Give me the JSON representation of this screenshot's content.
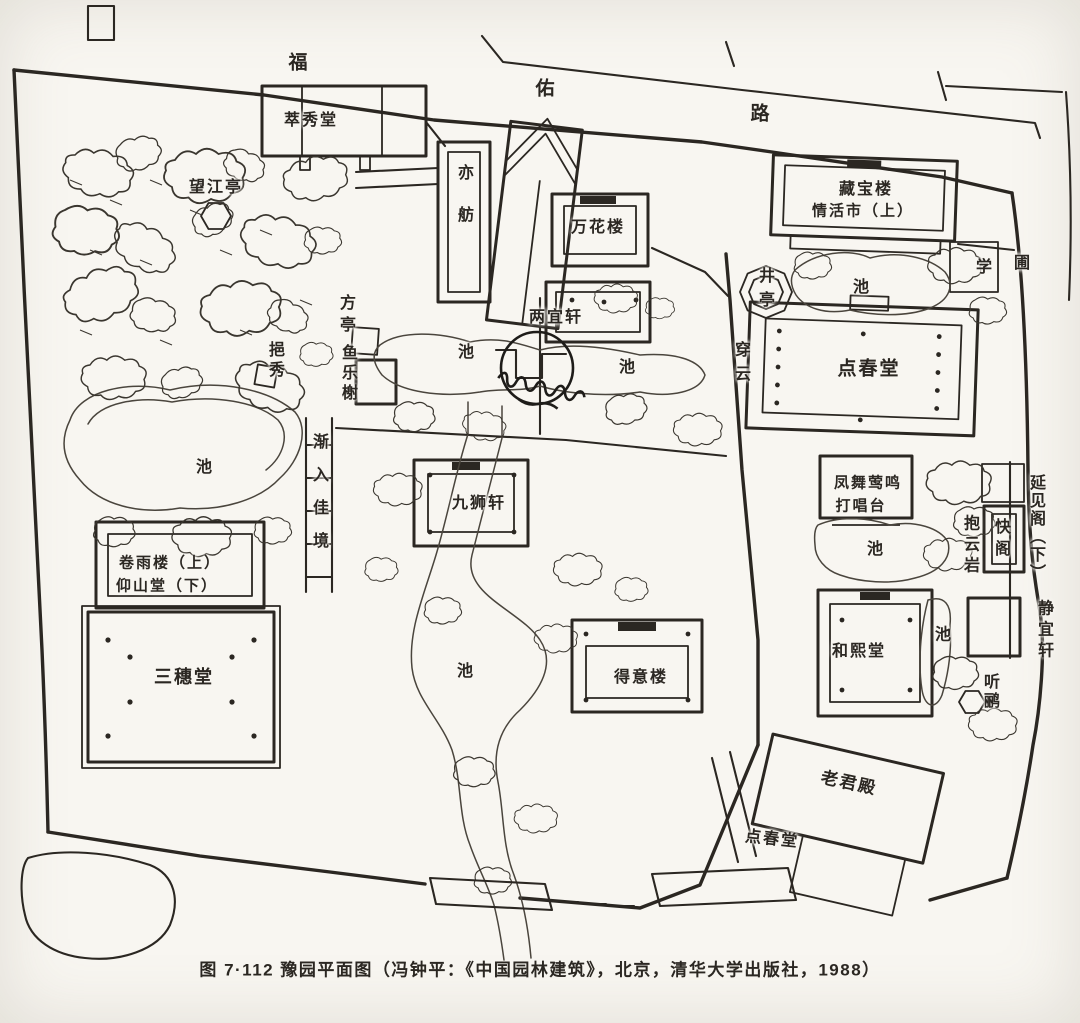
{
  "colors": {
    "paper": "#f8f6f1",
    "ink": "#2b2722",
    "water": "#4a453d"
  },
  "figure": {
    "caption": "图 7·112 豫园平面图（冯钟平：《中国园林建筑》，北京，清华大学出版社，1988）"
  },
  "road": {
    "name": "福佑路"
  },
  "labels": [
    {
      "name": "road-char",
      "text": "福",
      "x": 299,
      "y": 63,
      "dir": "h",
      "size": 19
    },
    {
      "name": "road-char",
      "text": "佑",
      "x": 546,
      "y": 89,
      "dir": "h",
      "size": 19
    },
    {
      "name": "road-char",
      "text": "路",
      "x": 761,
      "y": 114,
      "dir": "h",
      "size": 19
    },
    {
      "name": "label-cuixiutang",
      "text": "萃秀堂",
      "x": 311,
      "y": 121,
      "dir": "h"
    },
    {
      "name": "label-wangjiangting",
      "text": "望江亭",
      "x": 216,
      "y": 188,
      "dir": "h"
    },
    {
      "name": "label-yifang",
      "text": "亦舫",
      "x": 463,
      "y": 206,
      "dir": "v",
      "spacing": 26
    },
    {
      "name": "label-wanhualou",
      "text": "万花楼",
      "x": 598,
      "y": 228,
      "dir": "h"
    },
    {
      "name": "label-cangbaolou",
      "text": "藏宝楼",
      "x": 866,
      "y": 190,
      "dir": "h"
    },
    {
      "name": "label-cangbaolou-line2",
      "text": "情活市（上）",
      "x": 863,
      "y": 211,
      "dir": "h",
      "size": 15
    },
    {
      "name": "label-xue",
      "text": "学",
      "x": 985,
      "y": 268,
      "dir": "h"
    },
    {
      "name": "label-pu",
      "text": "圃",
      "x": 1023,
      "y": 264,
      "dir": "h"
    },
    {
      "name": "label-jingting",
      "text": "井亭",
      "x": 764,
      "y": 291,
      "dir": "v",
      "spacing": 8
    },
    {
      "name": "label-pond",
      "text": "池",
      "x": 862,
      "y": 288,
      "dir": "h"
    },
    {
      "name": "label-chuanyun",
      "text": "穿云",
      "x": 740,
      "y": 365,
      "dir": "v",
      "spacing": 8
    },
    {
      "name": "label-dianchuntang",
      "text": "点春堂",
      "x": 869,
      "y": 369,
      "dir": "h",
      "size": 19
    },
    {
      "name": "label-fangting",
      "text": "方亭",
      "x": 345,
      "y": 316,
      "dir": "v",
      "spacing": 6
    },
    {
      "name": "label-liangyixuan",
      "text": "两宜轩",
      "x": 556,
      "y": 318,
      "dir": "h"
    },
    {
      "name": "label-pond",
      "text": "池",
      "x": 467,
      "y": 353,
      "dir": "h"
    },
    {
      "name": "label-pond",
      "text": "池",
      "x": 628,
      "y": 368,
      "dir": "h"
    },
    {
      "name": "label-yulexie",
      "text": "鱼乐榭",
      "x": 347,
      "y": 374,
      "dir": "v",
      "spacing": 4
    },
    {
      "name": "label-yixiu",
      "text": "挹秀",
      "x": 274,
      "y": 361,
      "dir": "v",
      "spacing": 4
    },
    {
      "name": "label-pond",
      "text": "池",
      "x": 205,
      "y": 468,
      "dir": "h"
    },
    {
      "name": "label-jianrujiajing",
      "text": "渐入佳境",
      "x": 318,
      "y": 499,
      "dir": "v",
      "spacing": 17
    },
    {
      "name": "label-jiushixuan",
      "text": "九狮轩",
      "x": 479,
      "y": 504,
      "dir": "h"
    },
    {
      "name": "label-dachangtai-line1",
      "text": "凤舞莺鸣",
      "x": 868,
      "y": 483,
      "dir": "h",
      "size": 15
    },
    {
      "name": "label-dachangtai-line2",
      "text": "打唱台",
      "x": 861,
      "y": 506,
      "dir": "h",
      "size": 15
    },
    {
      "name": "label-pond",
      "text": "池",
      "x": 876,
      "y": 550,
      "dir": "h"
    },
    {
      "name": "label-baoyunyan",
      "text": "抱云岩",
      "x": 969,
      "y": 546,
      "dir": "v",
      "spacing": 5
    },
    {
      "name": "label-kuaige",
      "text": "快阁",
      "x": 1000,
      "y": 540,
      "dir": "v",
      "spacing": 6
    },
    {
      "name": "label-yanjiange",
      "text": "延见阁（下）",
      "x": 1035,
      "y": 528,
      "dir": "v",
      "spacing": 2
    },
    {
      "name": "label-jingyixuan",
      "text": "静宜轩",
      "x": 1043,
      "y": 631,
      "dir": "v",
      "spacing": 5
    },
    {
      "name": "label-juanyulou",
      "text": "卷雨楼（上）",
      "x": 170,
      "y": 563,
      "dir": "h",
      "size": 15
    },
    {
      "name": "label-yangshantang",
      "text": "仰山堂（下）",
      "x": 167,
      "y": 586,
      "dir": "h",
      "size": 15
    },
    {
      "name": "label-sansuitang",
      "text": "三穗堂",
      "x": 184,
      "y": 677,
      "dir": "h",
      "size": 18
    },
    {
      "name": "label-pond",
      "text": "池",
      "x": 466,
      "y": 672,
      "dir": "h"
    },
    {
      "name": "label-deyilou",
      "text": "得意楼",
      "x": 641,
      "y": 678,
      "dir": "h"
    },
    {
      "name": "label-hexitang",
      "text": "和熙堂",
      "x": 859,
      "y": 652,
      "dir": "h"
    },
    {
      "name": "label-pond",
      "text": "池",
      "x": 940,
      "y": 636,
      "dir": "v"
    },
    {
      "name": "label-tingli",
      "text": "听鹂",
      "x": 989,
      "y": 692,
      "dir": "v",
      "spacing": 3
    },
    {
      "name": "label-laojundian",
      "text": "老君殿",
      "x": 849,
      "y": 783,
      "dir": "h",
      "size": 17,
      "rotate": 12
    },
    {
      "name": "label-dianchuntang-gate",
      "text": "点春堂",
      "x": 772,
      "y": 840,
      "dir": "h",
      "rotate": 6
    }
  ]
}
